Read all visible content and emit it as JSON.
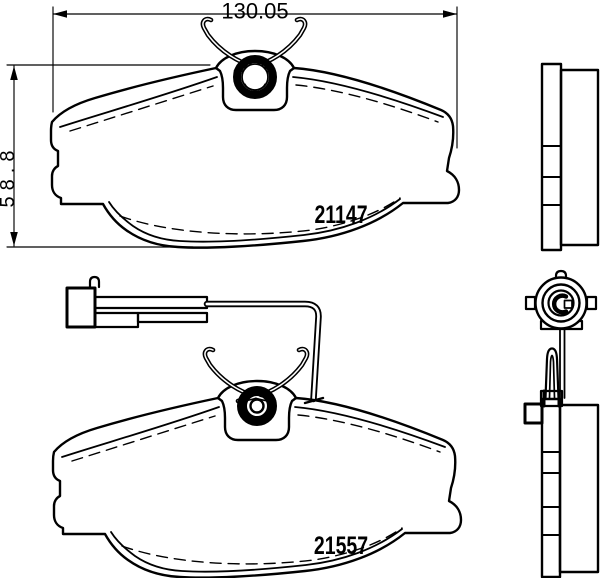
{
  "drawing": {
    "background_color": "#ffffff",
    "line_color": "#000000",
    "dimension_width": "130.05",
    "dimension_height": "58.8",
    "part_number_top": "21147",
    "part_number_bottom": "21557"
  }
}
